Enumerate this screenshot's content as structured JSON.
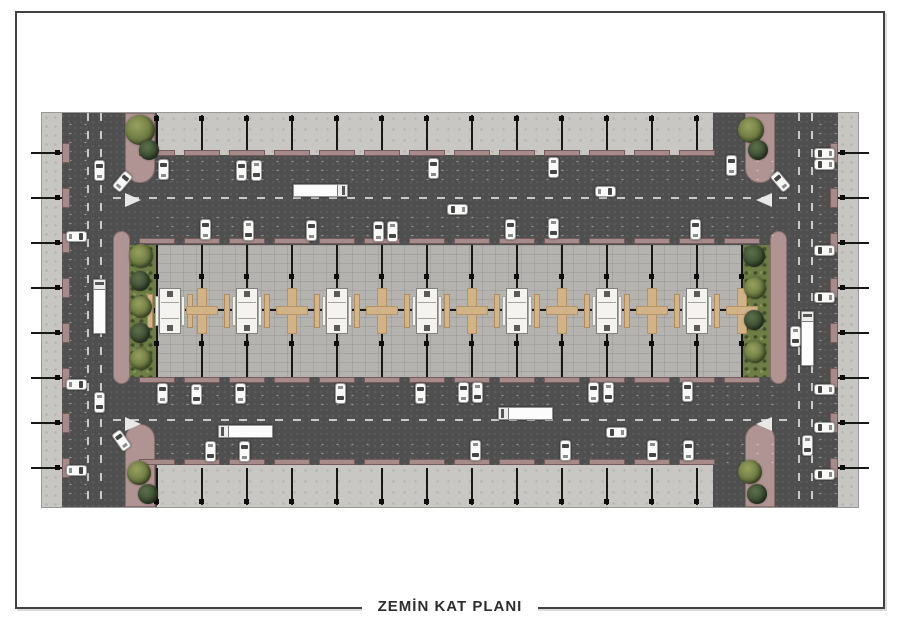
{
  "page": {
    "title_caption": "ZEMİN KAT PLANI"
  },
  "colors": {
    "paper": "#ffffff",
    "frame": "#414141",
    "asphalt": "#4f4f4f",
    "plaza": "#c8c7c3",
    "core_pavers": "#b4b3af",
    "mauve": "#a78b8b",
    "planter_mauve": "#b09494",
    "grass": "#6e7d46",
    "tree_dark": "#3e5034",
    "tree_light": "#6c7a42",
    "stall_tan": "#d2b388",
    "kiosk_white": "#f4f3f0",
    "column_black": "#171717",
    "road_marking": "#e8e8e6",
    "car_white": "#f9f9f8",
    "car_glass": "#454545"
  },
  "plan": {
    "x": 42,
    "y": 113,
    "w": 816,
    "h": 394,
    "sidewalks": [
      {
        "x": 42,
        "y": 113,
        "w": 20,
        "h": 394
      },
      {
        "x": 838,
        "y": 113,
        "w": 20,
        "h": 394
      }
    ],
    "arcades": [
      {
        "x": 157,
        "y": 113,
        "w": 556,
        "h": 42
      },
      {
        "x": 157,
        "y": 465,
        "w": 556,
        "h": 42
      }
    ],
    "core": {
      "x": 157,
      "y": 245,
      "w": 588,
      "h": 132
    },
    "green_strips": [
      {
        "x": 128,
        "y": 245,
        "w": 30,
        "h": 132
      },
      {
        "x": 742,
        "y": 245,
        "w": 30,
        "h": 132
      }
    ],
    "planters": [
      {
        "x": 125,
        "y": 113,
        "w": 30,
        "h": 70,
        "br": "0 0 15px 15px"
      },
      {
        "x": 113,
        "y": 231,
        "w": 17,
        "h": 153,
        "br": "9px"
      },
      {
        "x": 125,
        "y": 424,
        "w": 30,
        "h": 83,
        "br": "15px 15px 0 0"
      },
      {
        "x": 745,
        "y": 113,
        "w": 30,
        "h": 70,
        "br": "0 0 15px 15px"
      },
      {
        "x": 770,
        "y": 231,
        "w": 17,
        "h": 153,
        "br": "9px"
      },
      {
        "x": 745,
        "y": 424,
        "w": 30,
        "h": 83,
        "br": "15px 15px 0 0"
      }
    ],
    "parking_dot_zones": [
      {
        "x": 150,
        "y": 157,
        "w": 630,
        "h": 27
      },
      {
        "x": 150,
        "y": 213,
        "w": 630,
        "h": 27
      },
      {
        "x": 150,
        "y": 382,
        "w": 630,
        "h": 26
      },
      {
        "x": 150,
        "y": 440,
        "w": 630,
        "h": 25
      },
      {
        "x": 63,
        "y": 120,
        "w": 25,
        "h": 380
      },
      {
        "x": 813,
        "y": 120,
        "w": 25,
        "h": 380
      }
    ],
    "lane_dashes": [
      {
        "x": 113,
        "y": 198,
        "len": 676,
        "vert": false
      },
      {
        "x": 113,
        "y": 420,
        "len": 676,
        "vert": false
      },
      {
        "x": 88,
        "y": 113,
        "len": 394,
        "vert": true
      },
      {
        "x": 101,
        "y": 113,
        "len": 394,
        "vert": true
      },
      {
        "x": 799,
        "y": 113,
        "len": 394,
        "vert": true
      },
      {
        "x": 812,
        "y": 113,
        "len": 394,
        "vert": true
      }
    ],
    "yield_triangles": [
      {
        "x": 133,
        "y": 200,
        "d": "r"
      },
      {
        "x": 133,
        "y": 424,
        "d": "r"
      },
      {
        "x": 764,
        "y": 200,
        "d": "l"
      },
      {
        "x": 764,
        "y": 424,
        "d": "l"
      }
    ],
    "tick_rows_y": [
      153,
      198,
      243,
      288,
      333,
      378,
      423,
      468
    ],
    "band_columns_x": [
      157,
      202,
      247,
      292,
      337,
      382,
      427,
      472,
      517,
      562,
      607,
      652,
      697
    ],
    "core_columns_x": [
      157,
      202,
      247,
      292,
      337,
      382,
      427,
      472,
      517,
      562,
      607,
      652,
      697,
      742
    ],
    "core_rows_dot_y": [
      276,
      310,
      343
    ],
    "centerline_y": 310,
    "stalls": {
      "kiosks_x": [
        170,
        247,
        337,
        427,
        517,
        607,
        697
      ],
      "crosses_x": [
        202,
        292,
        382,
        472,
        562,
        652,
        742
      ],
      "center_y": 311
    }
  },
  "cars": [
    {
      "x": 163,
      "y": 169,
      "r": 0,
      "k": "car"
    },
    {
      "x": 241,
      "y": 170,
      "r": 0,
      "k": "car"
    },
    {
      "x": 256,
      "y": 170,
      "r": 180,
      "k": "car"
    },
    {
      "x": 433,
      "y": 168,
      "r": 0,
      "k": "car"
    },
    {
      "x": 553,
      "y": 167,
      "r": 180,
      "k": "car"
    },
    {
      "x": 731,
      "y": 165,
      "r": 0,
      "k": "car"
    },
    {
      "x": 320,
      "y": 190,
      "r": 90,
      "k": "truck"
    },
    {
      "x": 605,
      "y": 191,
      "r": 90,
      "k": "car"
    },
    {
      "x": 457,
      "y": 209,
      "r": 270,
      "k": "car"
    },
    {
      "x": 205,
      "y": 229,
      "r": 0,
      "k": "car"
    },
    {
      "x": 248,
      "y": 230,
      "r": 180,
      "k": "car"
    },
    {
      "x": 311,
      "y": 230,
      "r": 0,
      "k": "car"
    },
    {
      "x": 378,
      "y": 231,
      "r": 0,
      "k": "car"
    },
    {
      "x": 392,
      "y": 231,
      "r": 180,
      "k": "car"
    },
    {
      "x": 510,
      "y": 229,
      "r": 0,
      "k": "car"
    },
    {
      "x": 553,
      "y": 228,
      "r": 180,
      "k": "car"
    },
    {
      "x": 695,
      "y": 229,
      "r": 0,
      "k": "car"
    },
    {
      "x": 162,
      "y": 393,
      "r": 0,
      "k": "car"
    },
    {
      "x": 196,
      "y": 394,
      "r": 180,
      "k": "car"
    },
    {
      "x": 240,
      "y": 393,
      "r": 0,
      "k": "car"
    },
    {
      "x": 340,
      "y": 393,
      "r": 180,
      "k": "car"
    },
    {
      "x": 420,
      "y": 393,
      "r": 0,
      "k": "car"
    },
    {
      "x": 463,
      "y": 392,
      "r": 0,
      "k": "car"
    },
    {
      "x": 477,
      "y": 392,
      "r": 180,
      "k": "car"
    },
    {
      "x": 593,
      "y": 392,
      "r": 0,
      "k": "car"
    },
    {
      "x": 608,
      "y": 392,
      "r": 180,
      "k": "car"
    },
    {
      "x": 687,
      "y": 391,
      "r": 0,
      "k": "car"
    },
    {
      "x": 245,
      "y": 431,
      "r": 270,
      "k": "truck"
    },
    {
      "x": 525,
      "y": 413,
      "r": 270,
      "k": "truck"
    },
    {
      "x": 616,
      "y": 432,
      "r": 270,
      "k": "car"
    },
    {
      "x": 210,
      "y": 451,
      "r": 180,
      "k": "car"
    },
    {
      "x": 244,
      "y": 451,
      "r": 0,
      "k": "car"
    },
    {
      "x": 475,
      "y": 450,
      "r": 180,
      "k": "car"
    },
    {
      "x": 565,
      "y": 450,
      "r": 0,
      "k": "car"
    },
    {
      "x": 652,
      "y": 450,
      "r": 180,
      "k": "car"
    },
    {
      "x": 688,
      "y": 450,
      "r": 0,
      "k": "car"
    },
    {
      "x": 76,
      "y": 236,
      "r": 90,
      "k": "car"
    },
    {
      "x": 76,
      "y": 384,
      "r": 90,
      "k": "car"
    },
    {
      "x": 76,
      "y": 470,
      "r": 90,
      "k": "car"
    },
    {
      "x": 99,
      "y": 170,
      "r": 0,
      "k": "car"
    },
    {
      "x": 99,
      "y": 402,
      "r": 180,
      "k": "car"
    },
    {
      "x": 99,
      "y": 306,
      "r": 0,
      "k": "truck"
    },
    {
      "x": 122,
      "y": 181,
      "r": 40,
      "k": "car"
    },
    {
      "x": 121,
      "y": 440,
      "r": 325,
      "k": "car"
    },
    {
      "x": 824,
      "y": 153,
      "r": 270,
      "k": "car"
    },
    {
      "x": 824,
      "y": 164,
      "r": 270,
      "k": "car"
    },
    {
      "x": 824,
      "y": 250,
      "r": 270,
      "k": "car"
    },
    {
      "x": 824,
      "y": 297,
      "r": 270,
      "k": "car"
    },
    {
      "x": 824,
      "y": 389,
      "r": 270,
      "k": "car"
    },
    {
      "x": 824,
      "y": 427,
      "r": 270,
      "k": "car"
    },
    {
      "x": 824,
      "y": 474,
      "r": 270,
      "k": "car"
    },
    {
      "x": 795,
      "y": 336,
      "r": 180,
      "k": "car"
    },
    {
      "x": 807,
      "y": 338,
      "r": 0,
      "k": "truck"
    },
    {
      "x": 807,
      "y": 445,
      "r": 180,
      "k": "car"
    },
    {
      "x": 780,
      "y": 181,
      "r": 320,
      "k": "car"
    }
  ],
  "trees": [
    {
      "x": 140,
      "y": 130,
      "r": 15,
      "s": "light"
    },
    {
      "x": 149,
      "y": 150,
      "r": 10,
      "s": "dark"
    },
    {
      "x": 141,
      "y": 256,
      "r": 12,
      "s": "light"
    },
    {
      "x": 140,
      "y": 281,
      "r": 10,
      "s": "dark"
    },
    {
      "x": 141,
      "y": 307,
      "r": 11,
      "s": "light"
    },
    {
      "x": 140,
      "y": 333,
      "r": 10,
      "s": "dark"
    },
    {
      "x": 141,
      "y": 359,
      "r": 11,
      "s": "light"
    },
    {
      "x": 139,
      "y": 473,
      "r": 12,
      "s": "light"
    },
    {
      "x": 148,
      "y": 494,
      "r": 10,
      "s": "dark"
    },
    {
      "x": 751,
      "y": 130,
      "r": 13,
      "s": "light"
    },
    {
      "x": 758,
      "y": 150,
      "r": 10,
      "s": "dark"
    },
    {
      "x": 754,
      "y": 256,
      "r": 11,
      "s": "dark"
    },
    {
      "x": 755,
      "y": 288,
      "r": 11,
      "s": "light"
    },
    {
      "x": 754,
      "y": 320,
      "r": 10,
      "s": "dark"
    },
    {
      "x": 755,
      "y": 352,
      "r": 11,
      "s": "light"
    },
    {
      "x": 750,
      "y": 472,
      "r": 12,
      "s": "light"
    },
    {
      "x": 757,
      "y": 494,
      "r": 10,
      "s": "dark"
    }
  ]
}
